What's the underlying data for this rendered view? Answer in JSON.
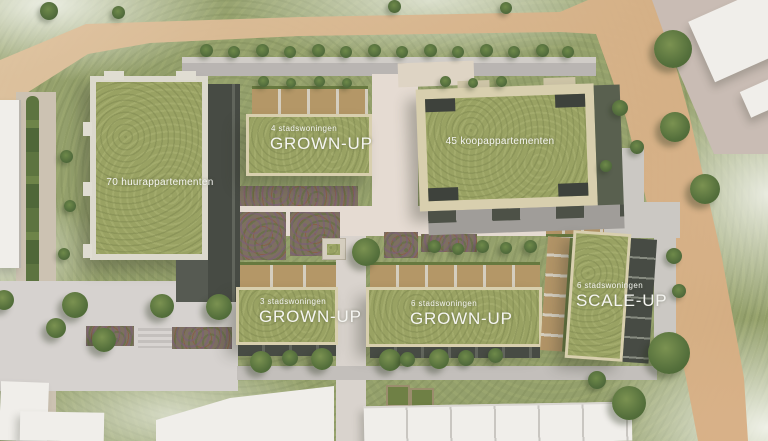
{
  "scene": {
    "description": "Aerial architectural site plan render of a housing development",
    "language": "Dutch"
  },
  "buildings": [
    {
      "id": "huurappartementen-70",
      "label": "70 huurappartementen"
    },
    {
      "id": "stadswoningen-4-grownup",
      "sublabel": "4 stadswoningen",
      "label": "GROWN-UP"
    },
    {
      "id": "koopappartementen-45",
      "label": "45 koopappartementen"
    },
    {
      "id": "stadswoningen-3-grownup",
      "sublabel": "3 stadswoningen",
      "label": "GROWN-UP"
    },
    {
      "id": "stadswoningen-6-grownup",
      "sublabel": "6 stadswoningen",
      "label": "GROWN-UP"
    },
    {
      "id": "stadswoningen-6-scaleup",
      "sublabel": "6 stadswoningen",
      "label": "SCALE-UP"
    }
  ],
  "colors": {
    "grass": "#94a06c",
    "roof_green": "#99a263",
    "roof_frame_beige": "#d8cfae",
    "roof_frame_white": "#dcd9cd",
    "sand_path": "#dcbc95",
    "road_gray": "#b8b4b1",
    "plaza_gray": "#d6d2cf",
    "courtyard_path": "#e5dbd2",
    "facade_dark": "#474b44",
    "terrace_tan": "#b49767",
    "white_building": "#f0eeea",
    "label_text": "#f5f5f1"
  }
}
